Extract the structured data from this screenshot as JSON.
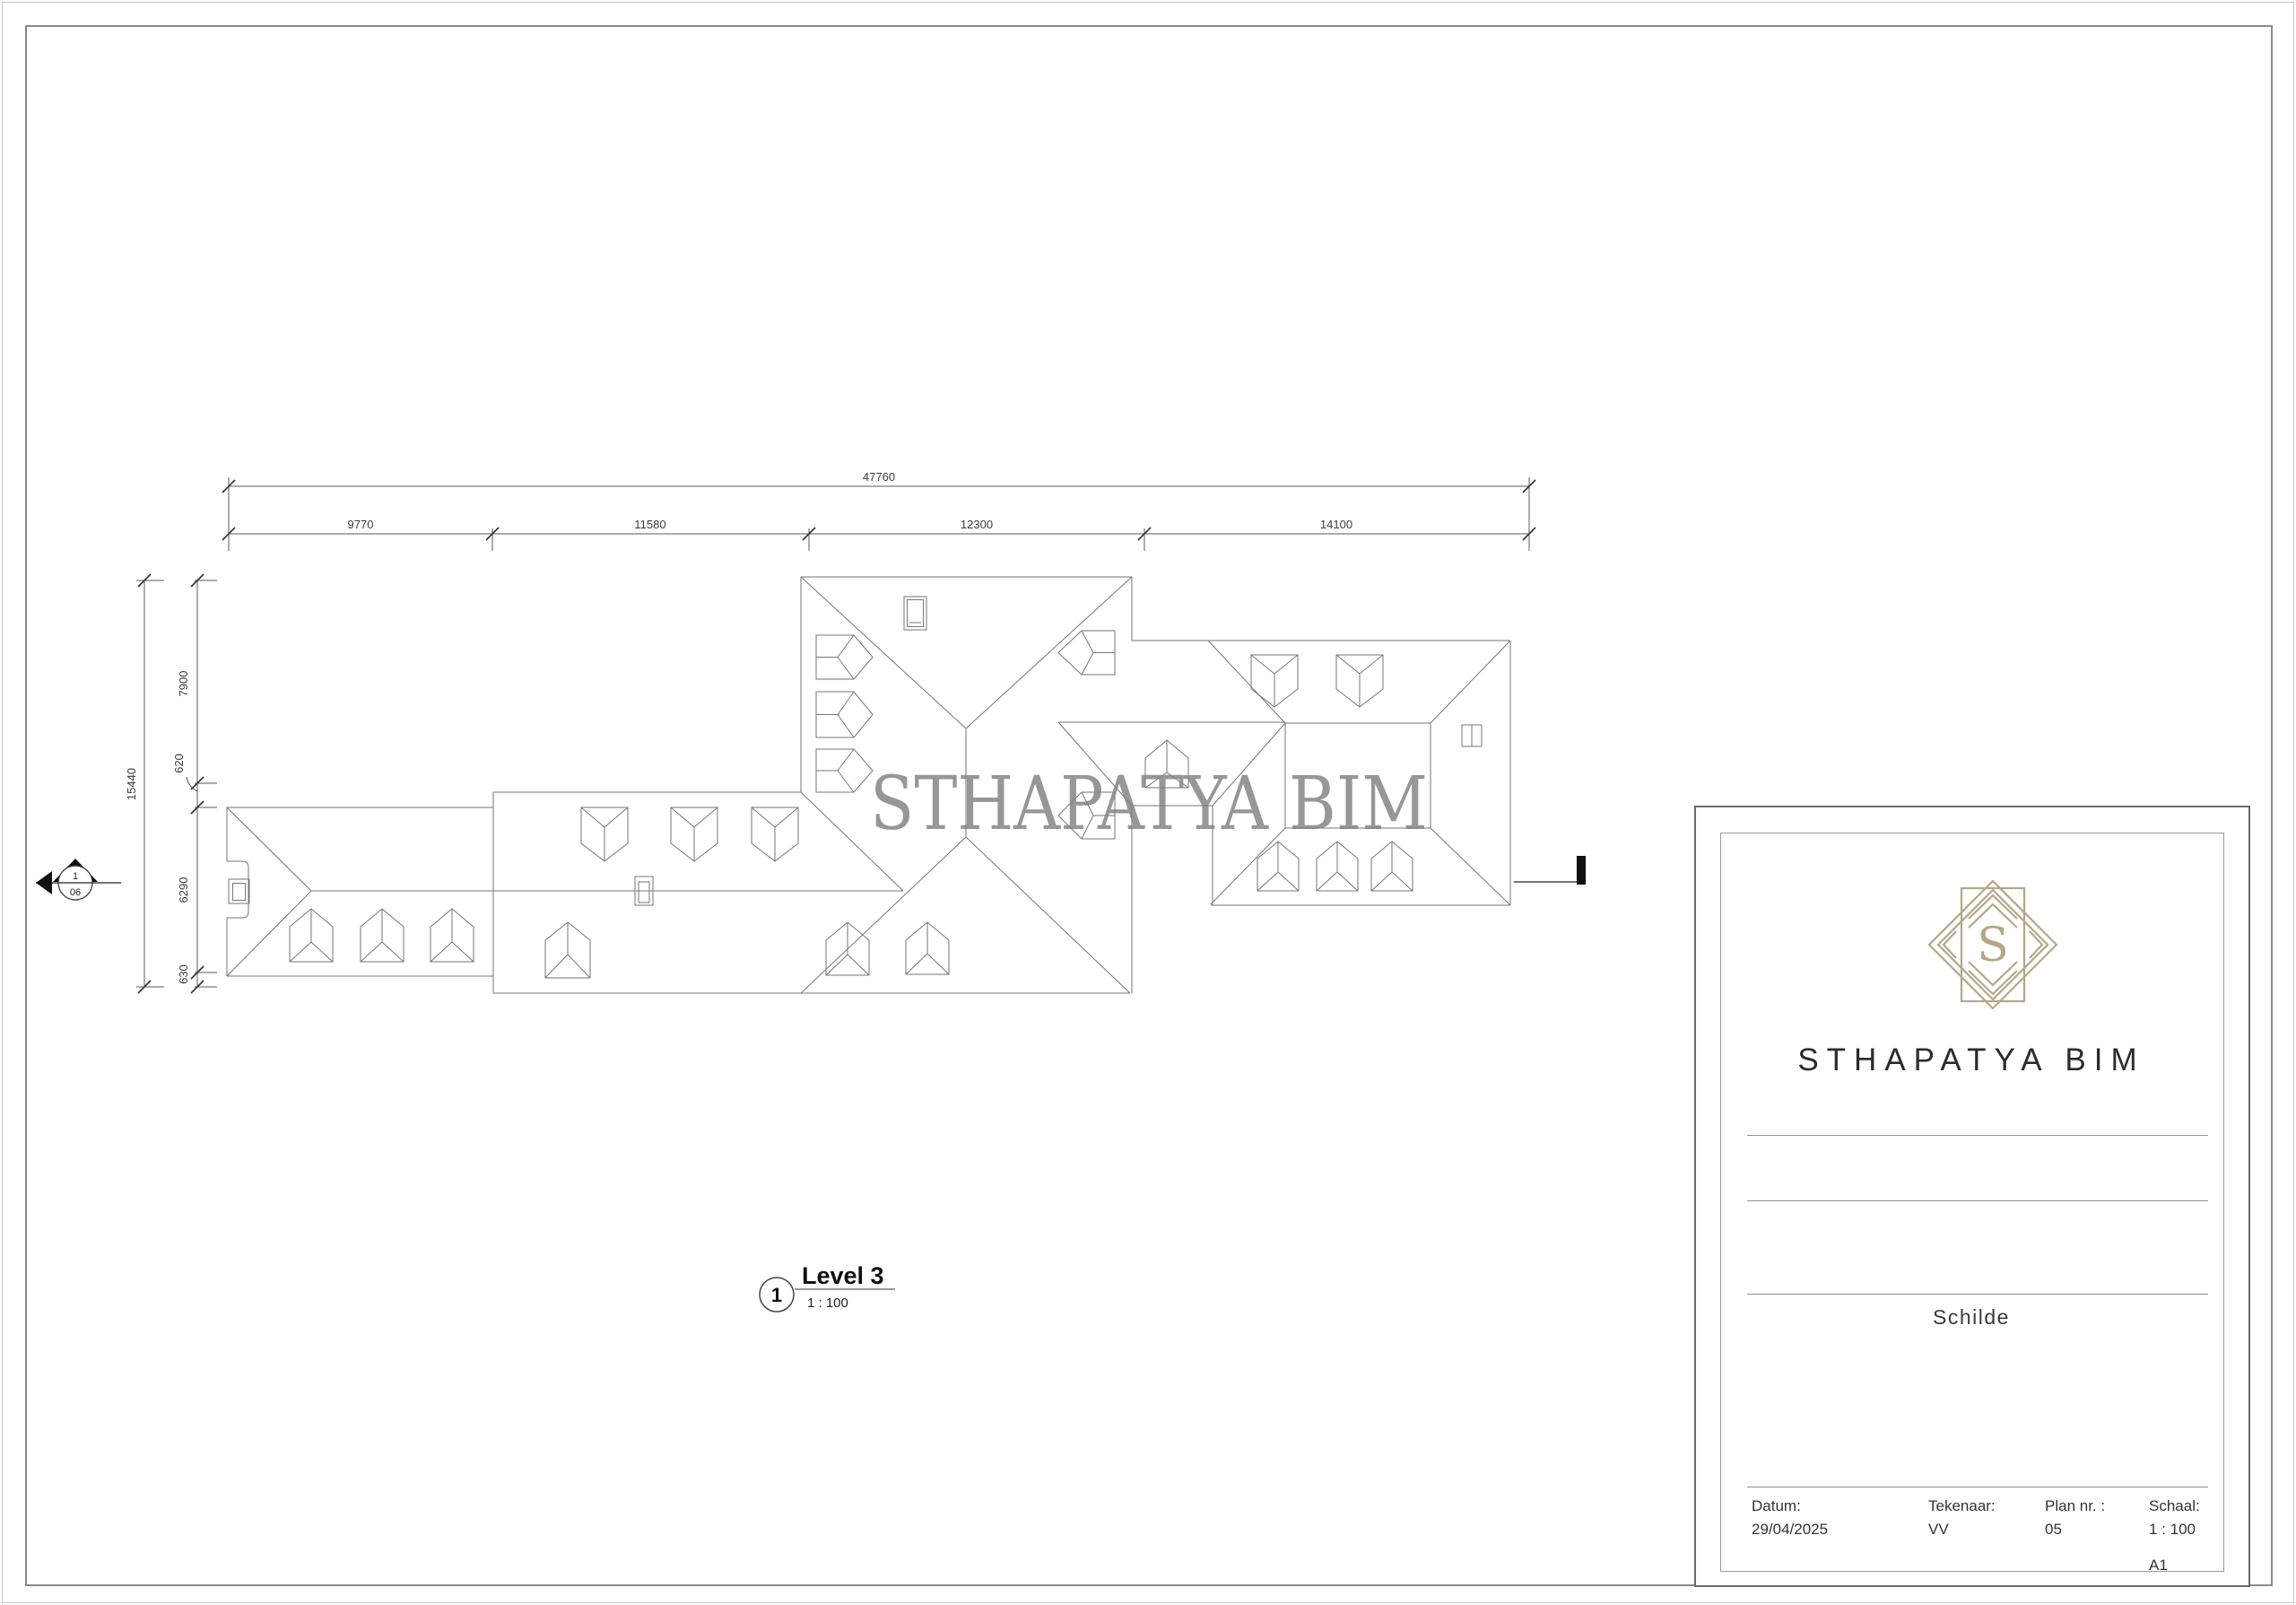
{
  "plan": {
    "watermark": "STHAPATYA BIM",
    "view_title": {
      "number": "1",
      "name": "Level 3",
      "scale": "1 : 100"
    },
    "section_marker": {
      "number": "1",
      "sheet": "06"
    },
    "dimensions": {
      "top_total": "47760",
      "top_segments": [
        "9770",
        "11580",
        "12300",
        "14100"
      ],
      "left_total": "15440",
      "left_segments": [
        "7900",
        "620",
        "6290",
        "630"
      ]
    }
  },
  "title_block": {
    "logo_letter": "S",
    "company": "STHAPATYA BIM",
    "project": "Schilde",
    "fields": [
      {
        "label": "Datum:",
        "value": "29/04/2025"
      },
      {
        "label": "Tekenaar:",
        "value": "VV"
      },
      {
        "label": "Plan nr. :",
        "value": "05"
      },
      {
        "label": "Schaal:",
        "value": "1 : 100"
      }
    ],
    "paper_size": "A1"
  }
}
